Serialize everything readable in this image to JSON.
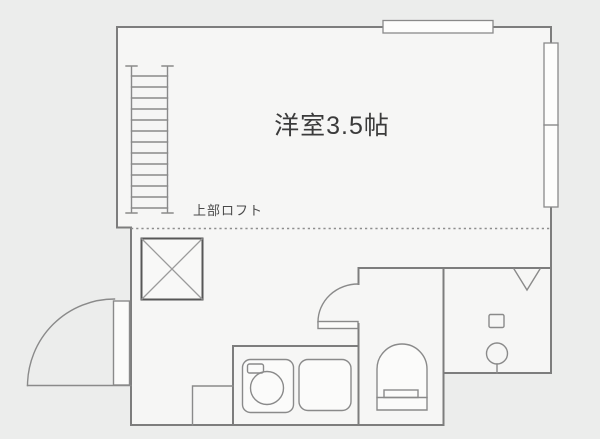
{
  "floorplan": {
    "labels": {
      "room": "洋室3.5帖",
      "loft": "上部ロフト"
    },
    "colors": {
      "background": "#ecedec",
      "floor_fill": "#f6f6f5",
      "wall_line": "#7d7d7d",
      "fixture_line": "#8a8a8a",
      "x_box_line": "#575757",
      "room_text": "#3b3b3b",
      "loft_text": "#4a4a4a"
    },
    "fixtures": [
      "loft-ladder",
      "closet-cross-box",
      "entrance-door-swing",
      "toilet-door-swing",
      "toilet",
      "washing-machine",
      "kitchen-sink-unit",
      "entry-step",
      "top-window",
      "right-sliding-window",
      "v-marker",
      "round-water-fixture",
      "small-square-fixture"
    ]
  }
}
